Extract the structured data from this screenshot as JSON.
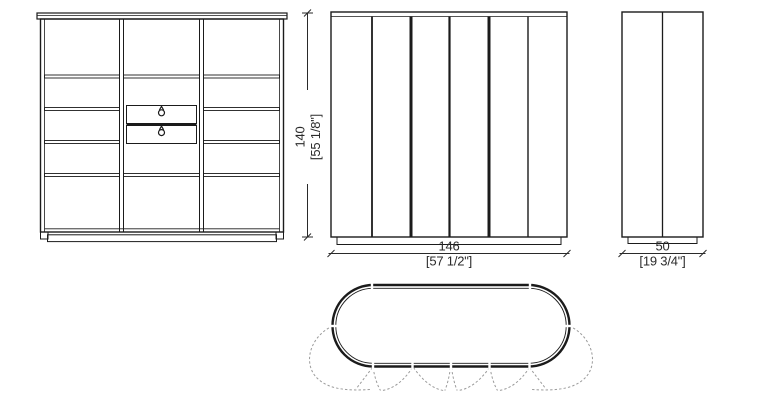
{
  "dimensions": {
    "height": {
      "metric": "140",
      "imperial": "[55 1/8\"]"
    },
    "width": {
      "metric": "146",
      "imperial": "[57 1/2\"]"
    },
    "depth": {
      "metric": "50",
      "imperial": "[19 3/4\"]"
    }
  },
  "colors": {
    "line": "#1b1b1b",
    "dimension_line": "#2a2a2a",
    "swing_dash": "#9b9b9b",
    "background": "#ffffff"
  }
}
